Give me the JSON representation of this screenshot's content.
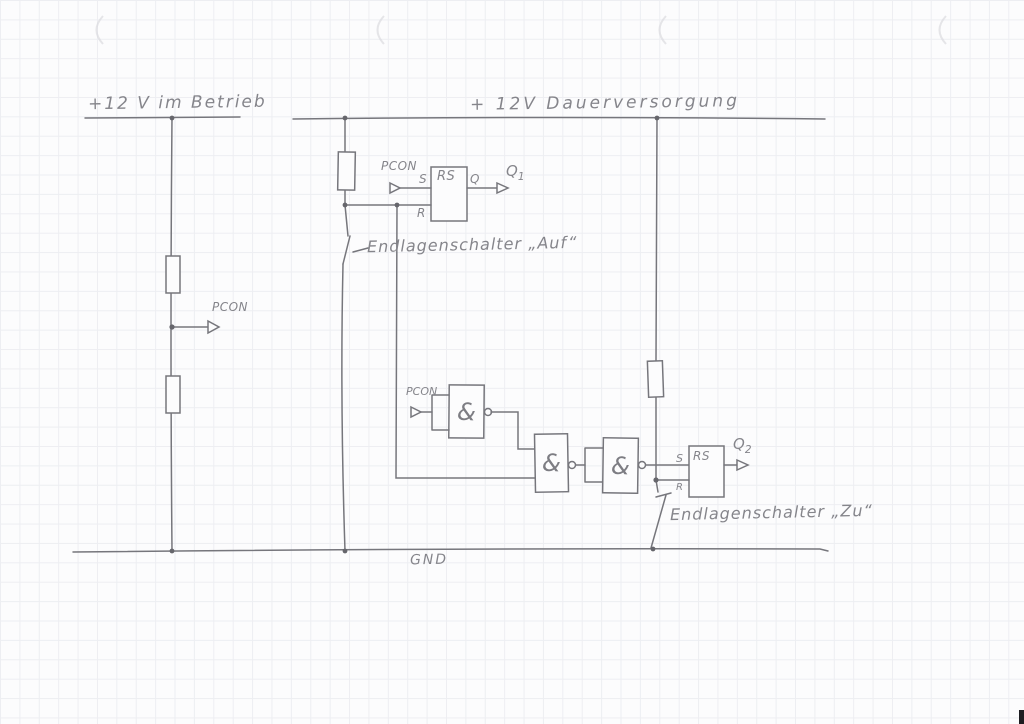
{
  "rails": {
    "left_supply": "+12 V im Betrieb",
    "right_supply": "+ 12V Dauerversorgung",
    "ground": "GND"
  },
  "divider": {
    "tap": "PCON"
  },
  "ff1": {
    "input": "PCON",
    "s": "S",
    "type": "RS",
    "q": "Q",
    "r": "R",
    "out": "Q",
    "out_sub": "1"
  },
  "ff2": {
    "s": "S",
    "type": "RS",
    "r": "R",
    "out": "Q",
    "out_sub": "2"
  },
  "gates": {
    "g1_input": "PCON",
    "g1": "&",
    "g2": "&",
    "g3": "&"
  },
  "switches": {
    "upper": "Endlagenschalter „Auf“",
    "lower": "Endlagenschalter „Zu“"
  }
}
